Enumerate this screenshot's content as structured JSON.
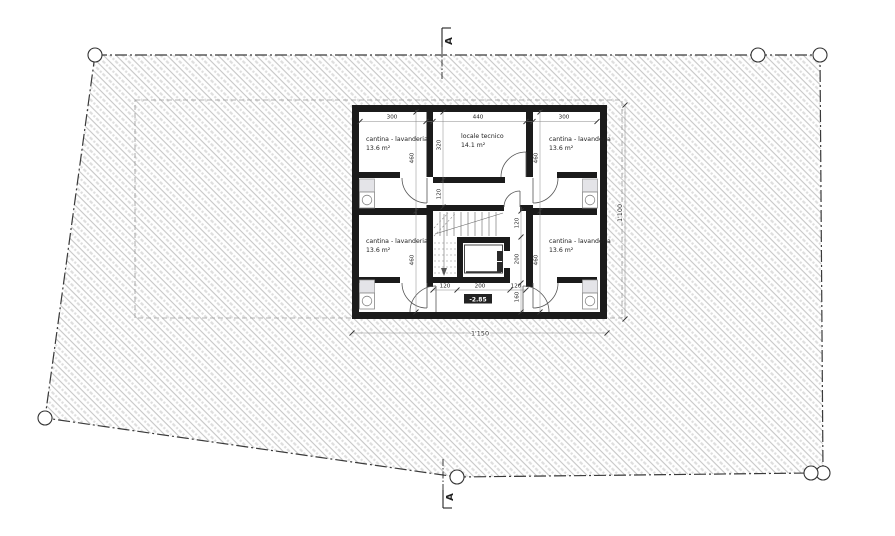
{
  "drawing": {
    "title": "basement floor plan",
    "section_marker": "A",
    "level_label": "-2.85",
    "rooms": {
      "top_left": {
        "name": "cantina - lavanderia",
        "area": "13.6 m²"
      },
      "top_right": {
        "name": "cantina - lavanderia",
        "area": "13.6 m²"
      },
      "bottom_left": {
        "name": "cantina - lavanderia",
        "area": "13.6 m²"
      },
      "bottom_right": {
        "name": "cantina - lavanderia",
        "area": "13.6 m²"
      },
      "technical": {
        "name": "locale tecnico",
        "area": "14.1 m²"
      }
    },
    "dims": {
      "top": [
        "300",
        "440",
        "300"
      ],
      "room_depth": "460",
      "tech_depth": "320",
      "corridor": "120",
      "vert_right": [
        "120",
        "200",
        "160"
      ],
      "bottom": [
        "120",
        "200",
        "120"
      ],
      "total_width": "1'150",
      "total_depth": "1'100"
    },
    "colors": {
      "wall": "#1b1b1b",
      "hatch": "#c6c6c6",
      "dim_line": "#888888",
      "boundary": "#3a3a3a"
    }
  }
}
